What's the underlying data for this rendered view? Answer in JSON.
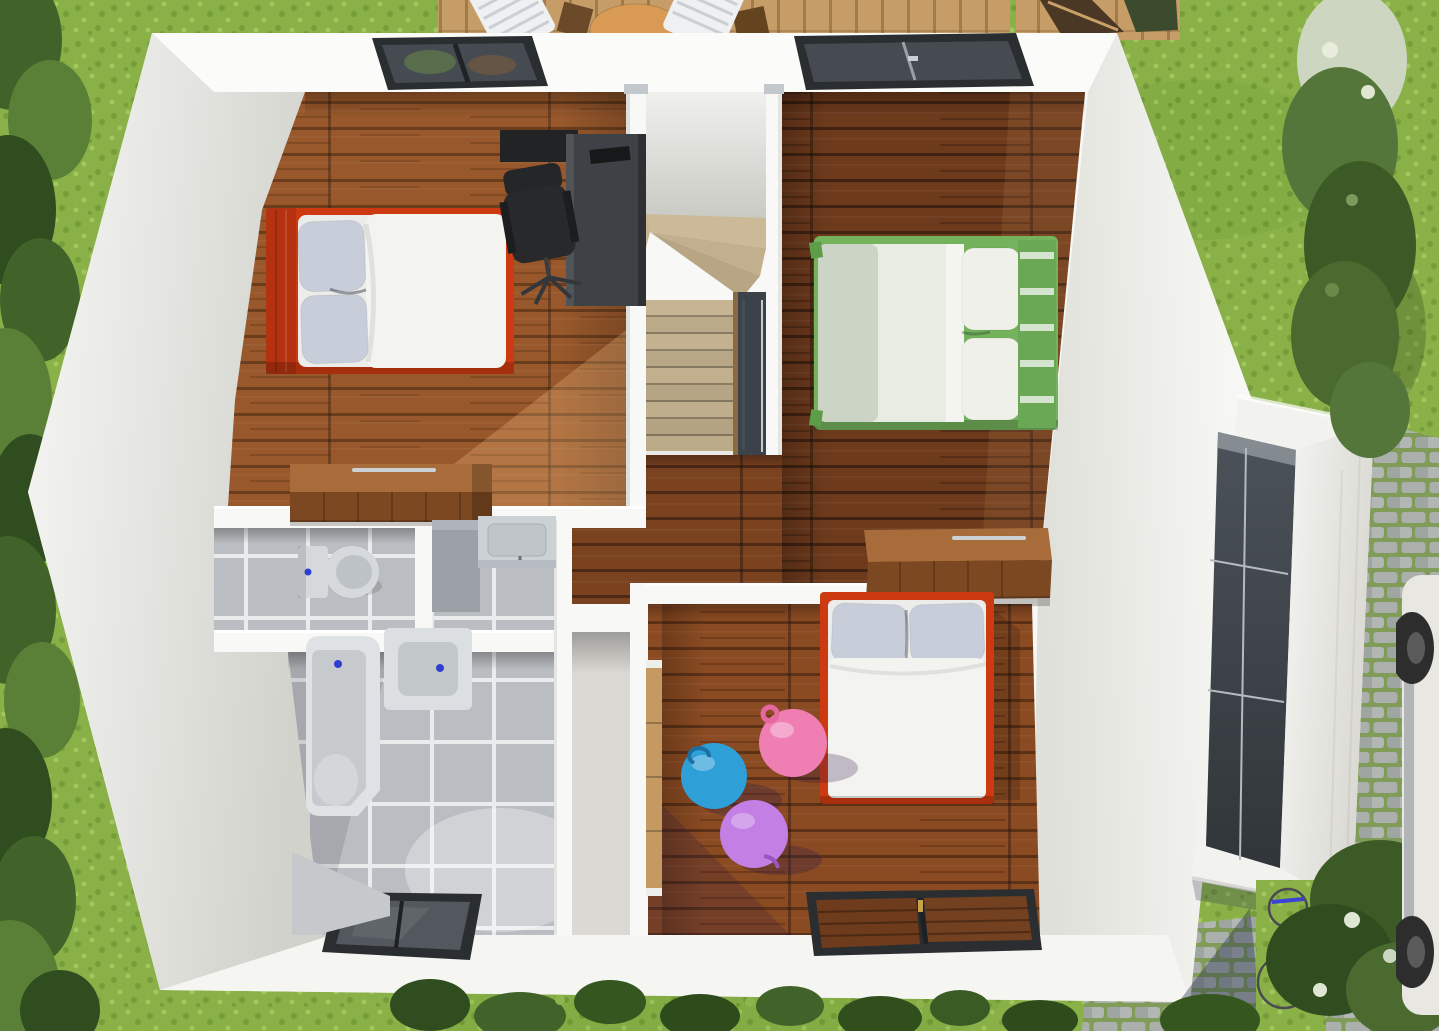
{
  "scene": {
    "type": "3d-floorplan-render",
    "view": "top-down-aerial",
    "storey": "upper-floor",
    "rooms": [
      {
        "id": "bedroom-northwest",
        "floor": "wood-medium",
        "features": [
          "double-bed-red",
          "desk",
          "office-chair",
          "dresser",
          "roof-window"
        ]
      },
      {
        "id": "bedroom-northeast",
        "floor": "wood-dark",
        "features": [
          "double-bed-green",
          "roof-window"
        ]
      },
      {
        "id": "kids-bedroom",
        "floor": "wood-medium",
        "features": [
          "single-bed-red",
          "play-balls",
          "sliding-wardrobe",
          "dresser",
          "roof-window"
        ]
      },
      {
        "id": "wc",
        "floor": "tile-grey",
        "features": [
          "toilet"
        ]
      },
      {
        "id": "vanity-niche",
        "floor": "tile-grey",
        "features": [
          "cabinet",
          "sink-counter",
          "faucet"
        ]
      },
      {
        "id": "bathroom",
        "floor": "tile-grey",
        "features": [
          "bathtub",
          "washbasin",
          "roof-window"
        ]
      },
      {
        "id": "corridor-closet",
        "floor": "screed",
        "features": []
      },
      {
        "id": "hallway-landing",
        "floor": "wood-dark",
        "features": [
          "dresser"
        ]
      },
      {
        "id": "stairwell",
        "floor": "stairs",
        "features": [
          "winder-stairs",
          "stair-void",
          "handrail"
        ]
      }
    ],
    "annex": {
      "id": "garage-annex",
      "features": [
        "sloped-white-roof",
        "dark-terrace-floor",
        "railing"
      ]
    },
    "environment": [
      "lawn",
      "hedge-row-left",
      "timber-deck-top",
      "deck-loungers",
      "round-table",
      "shrub-column-right",
      "cobblestone-path",
      "grass-strip",
      "bicycle-blue",
      "car-partial-right",
      "garden-plants-bottom",
      "flowering-shrubs"
    ]
  },
  "counts": {
    "roof_windows": 4,
    "beds": 3,
    "play_balls": 3,
    "deck_loungers": 2
  },
  "colors": {
    "grass1": "#8ab148",
    "grass2": "#759d39",
    "grass3": "#a2c75e",
    "hedge1": "#41632a",
    "hedge2": "#2f4d1e",
    "hedge3": "#5a8038",
    "deck": "#c69d66",
    "wall": "#f8f8f6",
    "woodNW": "#98582b",
    "woodNE": "#6e3a1c",
    "woodKid": "#8a4a22",
    "woodHall": "#7b4220",
    "tile": "#babdc1",
    "grout": "#e9ebec",
    "stair": "#c3b291",
    "void": "#3c4249",
    "bedred": "#cd3a12",
    "pillow": "#c8ced9",
    "duvet": "#f3f3f0",
    "bedgreen": "#74b25c",
    "desk": "#3e4145",
    "chair": "#28292b",
    "dressertop": "#a76c39",
    "dresserfront": "#7c4822",
    "wardrobe": "#c59a62",
    "fixture": "#d6d9dc",
    "fixturedark": "#bdc2c6",
    "drainblue": "#2f3fd0",
    "ballblue": "#2f9fd8",
    "ballpink": "#ef7fb2",
    "ballpurple": "#c37fe3",
    "frame": "#2b2e31",
    "glass": "#454b51",
    "stone": "#abb0ad",
    "moss": "#819b58",
    "terrace": "#4b5259",
    "rail": "#b4bac0",
    "bike": "#3a43d6",
    "car": "#e9e7e1",
    "wheel": "#2d2d2d"
  }
}
